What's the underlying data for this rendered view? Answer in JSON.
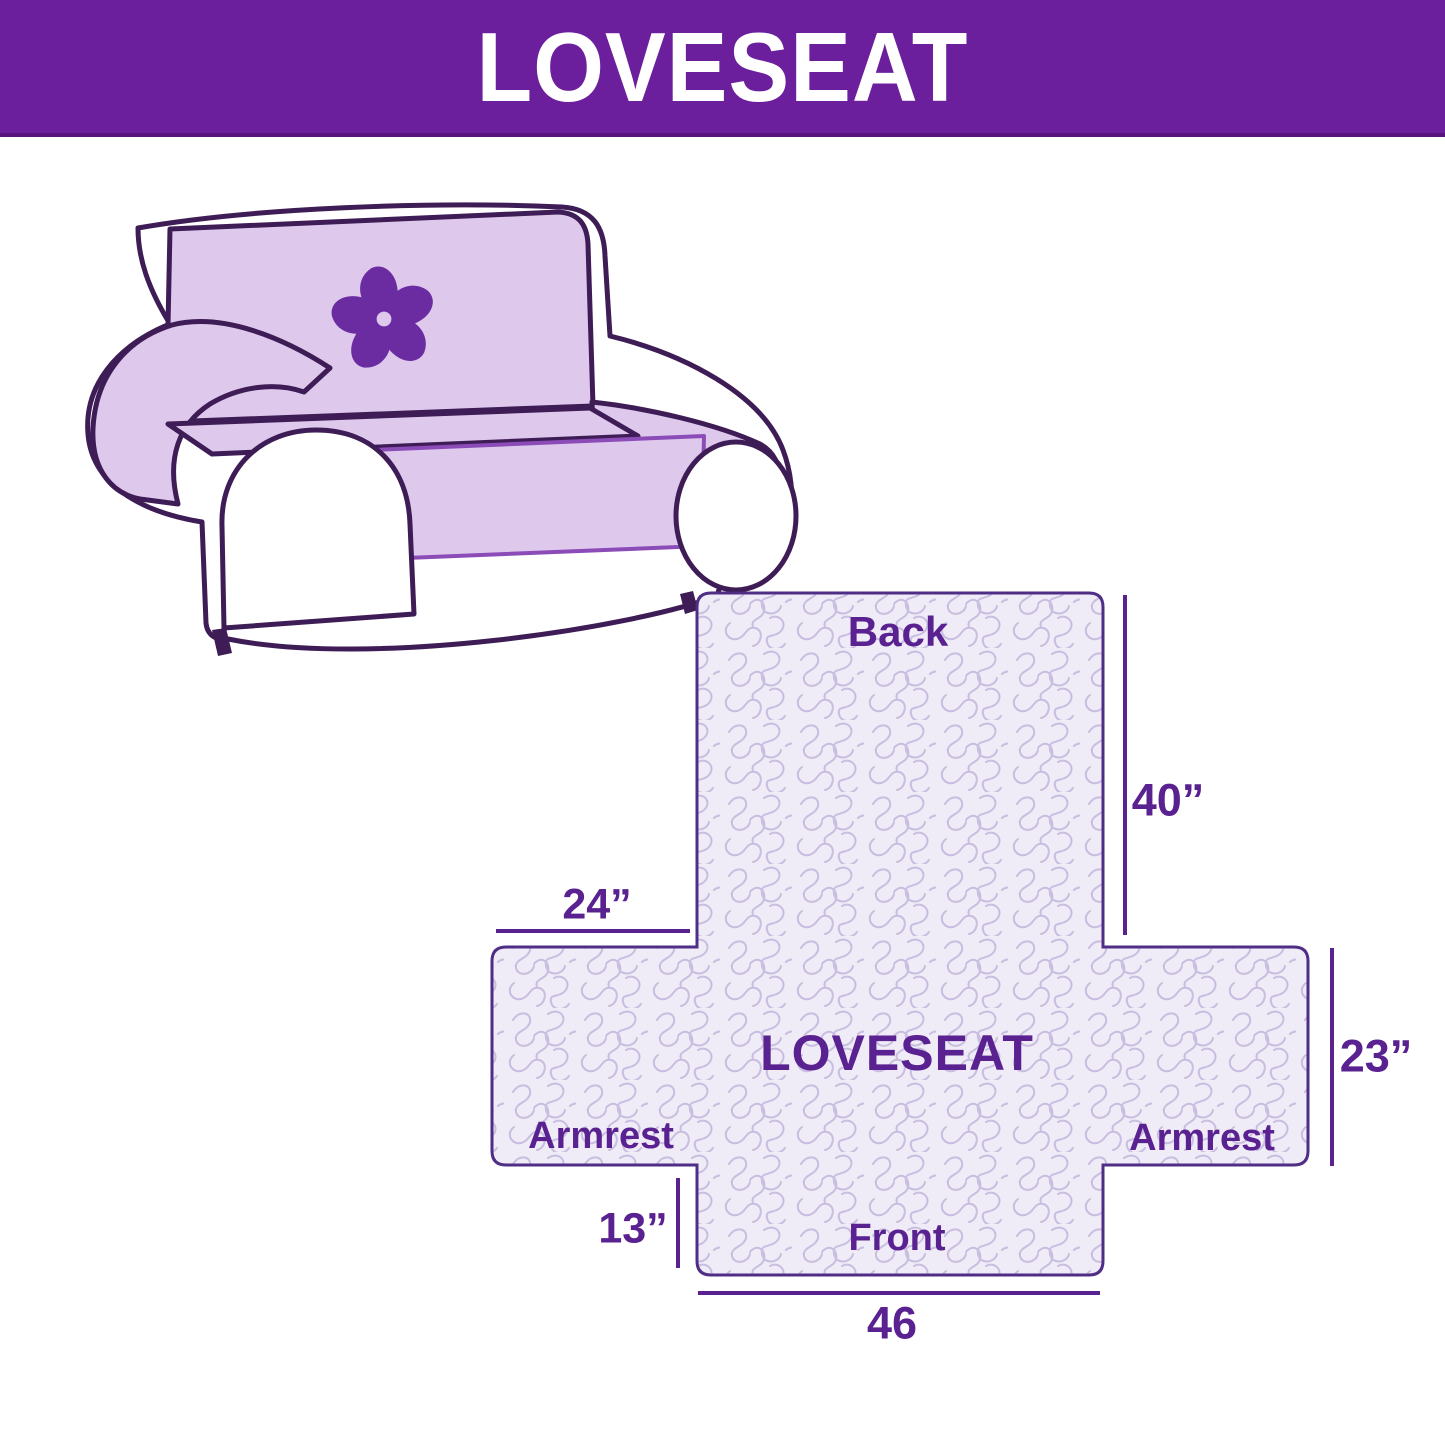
{
  "banner": {
    "title": "LOVESEAT",
    "bg_color": "#6B1F9C",
    "text_color": "#FFFFFF"
  },
  "illustration": {
    "description": "loveseat sofa with quilted furniture cover draped over back, seat and armrests",
    "logo_icon": "pinwheel-icon",
    "cover_color": "#DEC9ED",
    "outline_color": "#3E1C55",
    "logo_color": "#6A2CA0"
  },
  "diagram": {
    "center_label": "LOVESEAT",
    "sections": {
      "back": "Back",
      "front": "Front",
      "armrest_left": "Armrest",
      "armrest_right": "Armrest"
    },
    "dimensions": {
      "back_height": "40”",
      "armrest_top_width": "24”",
      "armrest_side_height": "23”",
      "front_flap_height": "13”",
      "front_bottom_width": "46"
    },
    "fill_color": "#EFEBF7",
    "pattern_color": "#C9BDE0",
    "outline_color": "#4F2E86",
    "dimension_line_color": "#5A2191",
    "text_color": "#5A2191"
  }
}
